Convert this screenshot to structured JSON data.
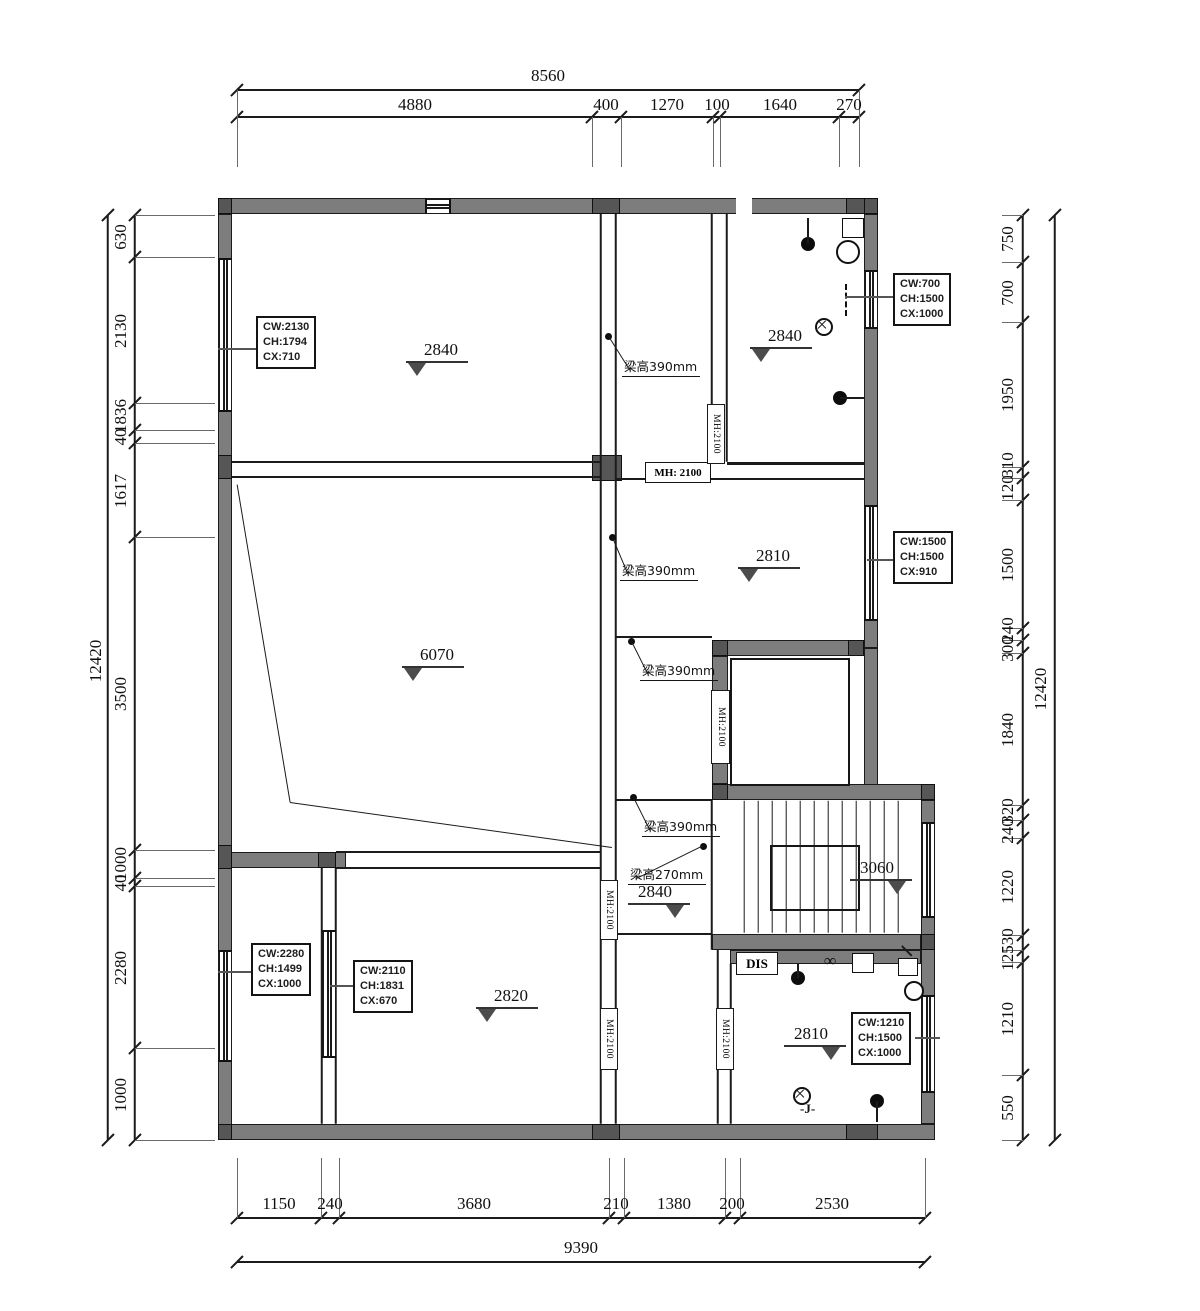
{
  "colors": {
    "background": "#ffffff",
    "wall_fill": "#7d7d7d",
    "column_fill": "#565656",
    "line": "#1b1b1b",
    "dim_text": "#0f0f0f",
    "level_triangle": "#4c4c4c"
  },
  "dimensions": {
    "top": {
      "overall": {
        "label": "8560",
        "line_y": 90,
        "x1": 237,
        "x2": 859,
        "label_x": 548,
        "label_y": 66
      },
      "chain_y": 117,
      "ticks": [
        237,
        592,
        621,
        713,
        720,
        839,
        859
      ],
      "label_y": 95,
      "labels": [
        {
          "t": "4880",
          "x": 415
        },
        {
          "t": "400",
          "x": 606
        },
        {
          "t": "1270",
          "x": 667
        },
        {
          "t": "100",
          "x": 717
        },
        {
          "t": "1640",
          "x": 780
        },
        {
          "t": "270",
          "x": 849
        }
      ]
    },
    "bottom": {
      "overall": {
        "label": "9390",
        "line_y": 1262,
        "x1": 237,
        "x2": 925,
        "label_x": 581,
        "label_y": 1238
      },
      "chain_y": 1218,
      "ticks": [
        237,
        321,
        339,
        609,
        624,
        725,
        740,
        925
      ],
      "label_y": 1194,
      "labels": [
        {
          "t": "1150",
          "x": 279
        },
        {
          "t": "240",
          "x": 330
        },
        {
          "t": "3680",
          "x": 474
        },
        {
          "t": "210",
          "x": 616
        },
        {
          "t": "1380",
          "x": 674
        },
        {
          "t": "200",
          "x": 732
        },
        {
          "t": "2530",
          "x": 832
        }
      ]
    },
    "left": {
      "overall": {
        "label": "12420",
        "line_x": 108,
        "y1": 215,
        "y2": 1140,
        "label_x": 96,
        "label_y": 660
      },
      "chain_x": 135,
      "ticks": [
        215,
        257,
        403,
        430,
        443,
        537,
        850,
        878,
        886,
        1048,
        1140
      ],
      "label_x": 121,
      "labels": [
        {
          "t": "630",
          "y": 236
        },
        {
          "t": "2130",
          "y": 330
        },
        {
          "t": "1836",
          "y": 415
        },
        {
          "t": "40",
          "y": 436
        },
        {
          "t": "1617",
          "y": 490
        },
        {
          "t": "3500",
          "y": 693
        },
        {
          "t": "1000",
          "y": 863
        },
        {
          "t": "40",
          "y": 882
        },
        {
          "t": "2280",
          "y": 967
        },
        {
          "t": "1000",
          "y": 1094
        }
      ]
    },
    "right": {
      "overall": {
        "label": "12420",
        "line_x": 1055,
        "y1": 215,
        "y2": 1140,
        "label_x": 1041,
        "label_y": 688
      },
      "chain_x": 1023,
      "ticks": [
        215,
        262,
        322,
        467,
        478,
        500,
        628,
        640,
        653,
        805,
        820,
        838,
        935,
        950,
        962,
        1075,
        1140
      ],
      "label_x": 1008,
      "labels": [
        {
          "t": "750",
          "y": 238
        },
        {
          "t": "700",
          "y": 292
        },
        {
          "t": "1950",
          "y": 394
        },
        {
          "t": "310",
          "y": 464
        },
        {
          "t": "120",
          "y": 487
        },
        {
          "t": "1500",
          "y": 564
        },
        {
          "t": "240",
          "y": 629
        },
        {
          "t": "300",
          "y": 648
        },
        {
          "t": "1840",
          "y": 729
        },
        {
          "t": "320",
          "y": 810
        },
        {
          "t": "240",
          "y": 830
        },
        {
          "t": "1220",
          "y": 886
        },
        {
          "t": "530",
          "y": 940
        },
        {
          "t": "125",
          "y": 957
        },
        {
          "t": "1210",
          "y": 1018
        },
        {
          "t": "550",
          "y": 1107
        }
      ]
    }
  },
  "plan": {
    "spec_boxes": [
      {
        "lines": [
          "CW:2130",
          "CH:1794",
          "CX:710"
        ],
        "x": 256,
        "y": 316,
        "leader": [
          218,
          349,
          256,
          349
        ]
      },
      {
        "lines": [
          "CW:700",
          "CH:1500",
          "CX:1000"
        ],
        "x": 893,
        "y": 273,
        "leader": [
          845,
          297,
          893,
          297
        ]
      },
      {
        "lines": [
          "CW:1500",
          "CH:1500",
          "CX:910"
        ],
        "x": 893,
        "y": 531,
        "leader": [
          867,
          560,
          893,
          560
        ]
      },
      {
        "lines": [
          "CW:2280",
          "CH:1499",
          "CX:1000"
        ],
        "x": 251,
        "y": 943,
        "leader": [
          218,
          972,
          251,
          972
        ]
      },
      {
        "lines": [
          "CW:2110",
          "CH:1831",
          "CX:670"
        ],
        "x": 353,
        "y": 960,
        "leader": [
          330,
          986,
          353,
          986
        ]
      },
      {
        "lines": [
          "CW:1210",
          "CH:1500",
          "CX:1000"
        ],
        "x": 851,
        "y": 1012,
        "leader": [
          915,
          1038,
          940,
          1038
        ]
      }
    ],
    "levels": [
      {
        "value": "2840",
        "x": 406,
        "y": 340,
        "tri": "left"
      },
      {
        "value": "2840",
        "x": 750,
        "y": 326,
        "tri": "left"
      },
      {
        "value": "2810",
        "x": 738,
        "y": 546,
        "tri": "left"
      },
      {
        "value": "6070",
        "x": 402,
        "y": 645,
        "tri": "left"
      },
      {
        "value": "2840",
        "x": 628,
        "y": 882,
        "tri": "right"
      },
      {
        "value": "3060",
        "x": 850,
        "y": 858,
        "tri": "right"
      },
      {
        "value": "2820",
        "x": 476,
        "y": 986,
        "tri": "left"
      },
      {
        "value": "2810",
        "x": 784,
        "y": 1024,
        "tri": "right"
      }
    ],
    "beams": [
      {
        "text": "梁高390mm",
        "x": 622,
        "y": 356,
        "dot": [
          608,
          336
        ]
      },
      {
        "text": "梁高390mm",
        "x": 620,
        "y": 560,
        "dot": [
          612,
          537
        ]
      },
      {
        "text": "梁高390mm",
        "x": 640,
        "y": 660,
        "dot": [
          631,
          641
        ]
      },
      {
        "text": "梁高390mm",
        "x": 642,
        "y": 816,
        "dot": [
          633,
          797
        ]
      },
      {
        "text": "梁高270mm",
        "x": 628,
        "y": 864,
        "dot": [
          703,
          846
        ]
      }
    ],
    "mh": [
      {
        "text": "MH: 2100",
        "orient": "h",
        "x": 645,
        "y": 462,
        "w": 64,
        "h": 19
      },
      {
        "text": "MH:2100",
        "orient": "v",
        "x": 707,
        "y": 404,
        "w": 16,
        "h": 58
      },
      {
        "text": "MH:2100",
        "orient": "v",
        "x": 711,
        "y": 690,
        "w": 17,
        "h": 72
      },
      {
        "text": "MH:2100",
        "orient": "v",
        "x": 600,
        "y": 880,
        "w": 16,
        "h": 58
      },
      {
        "text": "MH:2100",
        "orient": "v",
        "x": 600,
        "y": 1008,
        "w": 16,
        "h": 60
      },
      {
        "text": "MH:2100",
        "orient": "v",
        "x": 716,
        "y": 1008,
        "w": 16,
        "h": 60
      }
    ],
    "misc": [
      {
        "id": "dis-label",
        "text": "DIS",
        "x": 736,
        "y": 952,
        "w": 40,
        "h": 21
      },
      {
        "id": "j-label",
        "text": "-J-",
        "x": 800,
        "y": 1101
      },
      {
        "id": "infinity-label",
        "text": "∞",
        "x": 824,
        "y": 951
      }
    ]
  }
}
